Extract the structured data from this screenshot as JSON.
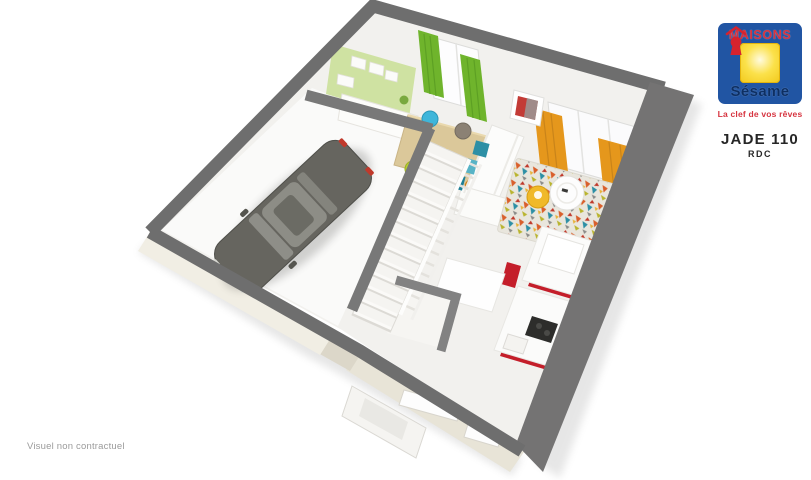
{
  "brand": {
    "name": "MAISONS",
    "subname": "Sésame",
    "tagline": "La clef de vos rêves"
  },
  "plan": {
    "title": "JADE 110",
    "level": "RDC"
  },
  "footer": {
    "disclaimer": "Visuel non contractuel"
  },
  "colors": {
    "brand_blue": "#2155a3",
    "brand_yellow": "#f8d01f",
    "brand_red": "#d6333f",
    "brand_navy": "#0d2f63",
    "wall_gray": "#6e6e6e",
    "kitchen_red": "#c41e2a",
    "curtain_orange": "#e5971c",
    "curtain_green": "#6fb42c",
    "accent_wall_green": "#cfe2a2"
  }
}
